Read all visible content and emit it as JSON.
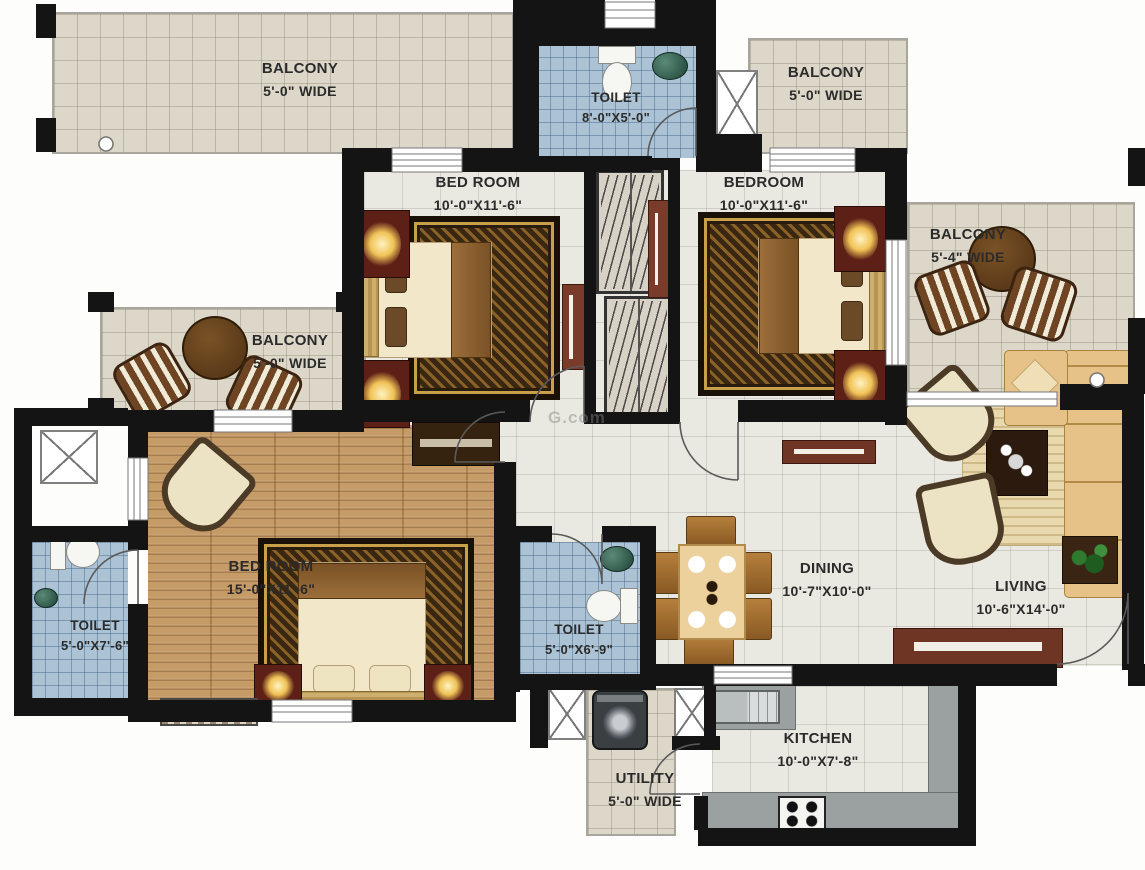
{
  "plan": {
    "watermark": "G.com",
    "rooms": [
      {
        "id": "balcony_top_left",
        "name": "BALCONY",
        "dims": "5'-0\" WIDE"
      },
      {
        "id": "toilet_top",
        "name": "TOILET",
        "dims": "8'-0\"X5'-0\""
      },
      {
        "id": "balcony_top_right",
        "name": "BALCONY",
        "dims": "5'-0\" WIDE"
      },
      {
        "id": "bedroom_1",
        "name": "BED ROOM",
        "dims": "10'-0\"X11'-6\""
      },
      {
        "id": "bedroom_2",
        "name": "BEDROOM",
        "dims": "10'-0\"X11'-6\""
      },
      {
        "id": "balcony_right",
        "name": "BALCONY",
        "dims": "5'-4\" WIDE"
      },
      {
        "id": "balcony_left",
        "name": "BALCONY",
        "dims": "5'-0\" WIDE"
      },
      {
        "id": "master_bedroom",
        "name": "BED ROOM",
        "dims": "15'-0\"X11'-6\""
      },
      {
        "id": "toilet_left",
        "name": "TOILET",
        "dims": "5'-0\"X7'-6\""
      },
      {
        "id": "toilet_mid",
        "name": "TOILET",
        "dims": "5'-0\"X6'-9\""
      },
      {
        "id": "dining",
        "name": "DINING",
        "dims": "10'-7\"X10'-0\""
      },
      {
        "id": "living",
        "name": "LIVING",
        "dims": "10'-6\"X14'-0\""
      },
      {
        "id": "kitchen",
        "name": "KITCHEN",
        "dims": "10'-0\"X7'-8\""
      },
      {
        "id": "utility",
        "name": "UTILITY",
        "dims": "5'-0\" WIDE"
      }
    ],
    "colors": {
      "wall": "#141414",
      "floor_cream": "#eae9e1",
      "floor_blue": "#abc3d5",
      "floor_wood": "#c59b68",
      "floor_balcony": "#dcd7c8",
      "counter_gray": "#9ba1a1",
      "rug_gold": "#c9a04a"
    }
  }
}
